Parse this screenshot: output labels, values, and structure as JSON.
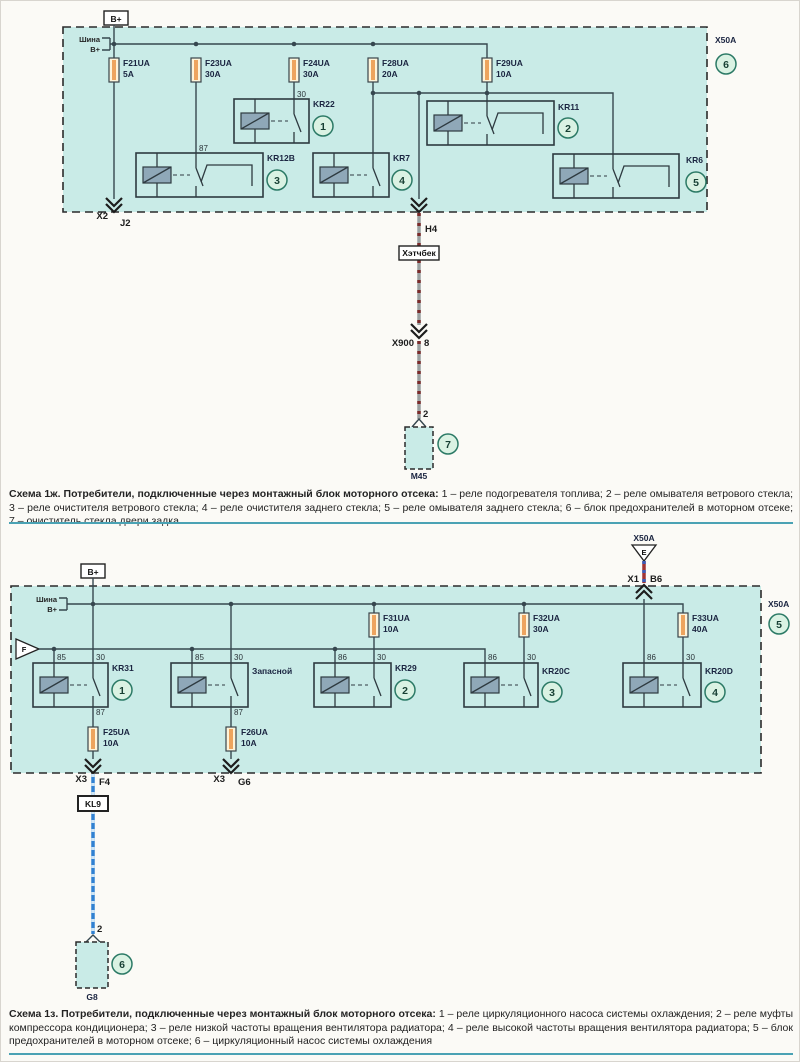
{
  "colors": {
    "block_fill": "#c9ebe7",
    "wire": "#36474f",
    "border": "#2b2b2b",
    "fuse_fill": "#fdf4da",
    "fuse_band": "#eda45e",
    "coil_fill": "#8fa8b8",
    "circle_fill": "#daf2e3",
    "circle_stroke": "#2c7a66",
    "label": "#1a2440",
    "conn_text": "#1d1d1d",
    "wire1_base": "#9aa0a0",
    "wire1_stripe": "#7b2b2b",
    "wire2_base": "#a03434",
    "wire2_stripe": "#3a5cb8",
    "wire3_base": "#3181d2",
    "wire3_stripe": "#cfe6f7",
    "divider": "#4aa2b4",
    "caption_text": "#232323"
  },
  "diagram1": {
    "power_label": "B+",
    "bus_label_top": "Шина",
    "bus_label_bottom": "B+",
    "connector_label": "X50A",
    "block_callout": "6",
    "fuses": [
      {
        "name": "F21UA",
        "amp": "5A"
      },
      {
        "name": "F23UA",
        "amp": "30A"
      },
      {
        "name": "F24UA",
        "amp": "30A"
      },
      {
        "name": "F28UA",
        "amp": "20A"
      },
      {
        "name": "F29UA",
        "amp": "10A"
      }
    ],
    "pin_30": "30",
    "pin_87": "87",
    "relays": [
      {
        "name": "KR22",
        "num": "1"
      },
      {
        "name": "KR11",
        "num": "2"
      },
      {
        "name": "KR12B",
        "num": "3"
      },
      {
        "name": "KR7",
        "num": "4"
      },
      {
        "name": "KR6",
        "num": "5"
      }
    ],
    "exit_left_conn": "X2",
    "exit_left_pin": "J2",
    "exit_mid_pin": "H4",
    "body_tag": "Хэтчбек",
    "splice_name": "X900",
    "splice_pin": "8",
    "device_pin": "2",
    "device_name": "M45",
    "device_callout": "7"
  },
  "diagram2": {
    "power_label": "B+",
    "bus_label_top": "Шина",
    "bus_label_bottom": "B+",
    "top_conn_label": "X50A",
    "top_conn_tri": "E",
    "top_conn_name": "X1",
    "top_conn_pin": "B6",
    "left_tri": "F",
    "connector_label": "X50A",
    "block_callout": "5",
    "fuses_top": [
      {
        "name": "F31UA",
        "amp": "10A"
      },
      {
        "name": "F32UA",
        "amp": "30A"
      },
      {
        "name": "F33UA",
        "amp": "40A"
      }
    ],
    "fuses_bottom": [
      {
        "name": "F25UA",
        "amp": "10A"
      },
      {
        "name": "F26UA",
        "amp": "10A"
      }
    ],
    "relays": [
      {
        "name": "KR31",
        "num": "1",
        "pin_coil": "85",
        "pin_sw": "30",
        "pin_out": "87"
      },
      {
        "name": "Запасной",
        "num": "",
        "pin_coil": "85",
        "pin_sw": "30",
        "pin_out": "87"
      },
      {
        "name": "KR29",
        "num": "2",
        "pin_coil": "86",
        "pin_sw": "30"
      },
      {
        "name": "KR20C",
        "num": "3",
        "pin_coil": "86",
        "pin_sw": "30"
      },
      {
        "name": "KR20D",
        "num": "4",
        "pin_coil": "86",
        "pin_sw": "30"
      }
    ],
    "exit_left_conn": "X3",
    "exit_left_pin": "F4",
    "exit_right_conn": "X3",
    "exit_right_pin": "G6",
    "relay_tag": "KL9",
    "device_pin": "2",
    "device_name": "G8",
    "device_callout": "6"
  },
  "captions": [
    {
      "bold": "Схема 1ж. Потребители, подключенные через монтажный блок моторного отсека:",
      "text": "1 – реле подогревателя топлива; 2 – реле омывателя ветрового стекла; 3 – реле очистителя ветрового стекла; 4 – реле очистителя заднего стекла; 5 – реле омывателя заднего стекла; 6 – блок предохранителей в моторном отсеке; 7 – очиститель стекла двери задка"
    },
    {
      "bold": "Схема 1з. Потребители, подключенные через монтажный блок моторного отсека:",
      "text": "1 – реле циркуляционного насоса системы охлаждения; 2 – реле муфты компрессора кондиционера; 3 – реле низкой частоты вращения вентилятора радиатора; 4 – реле высокой частоты вращения вентилятора радиатора; 5 – блок предохранителей в моторном отсеке; 6 – циркуляционный насос системы охлаждения"
    }
  ]
}
